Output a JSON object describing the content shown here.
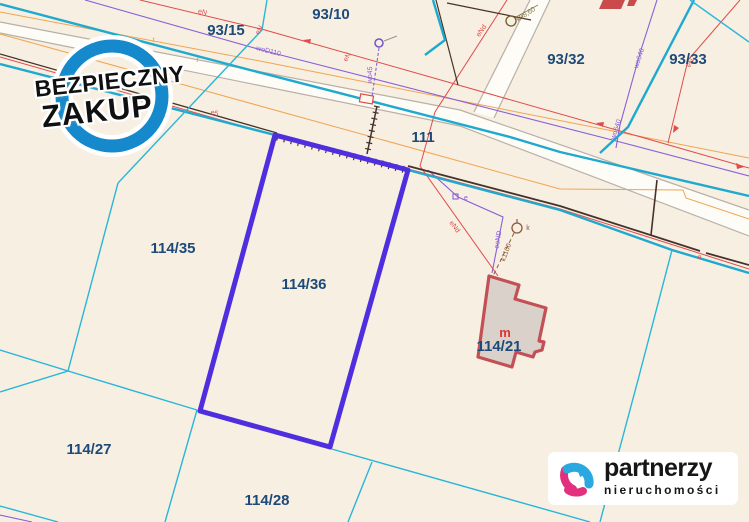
{
  "colors": {
    "background": "#f7efe2",
    "parcel_label": "#1d4a78",
    "boundary_cyan": "#21aed2",
    "highlight_purple": "#4f2ee0",
    "road_gray": "#b8b0a6",
    "utility_orange": "#e8973f",
    "utility_red": "#e14b4b",
    "utility_purple": "#8a5fd6",
    "fence_dark": "#46322a",
    "building_stroke": "#c25055",
    "building_fill": "#d9d1ca",
    "stamp_blue": "#1589cb",
    "logo_pink": "#e2307e",
    "logo_blue": "#2aa9e0"
  },
  "map": {
    "parcels": [
      {
        "label": "93/15"
      },
      {
        "label": "93/10"
      },
      {
        "label": "93/32"
      },
      {
        "label": "93/33"
      },
      {
        "label": "111"
      },
      {
        "label": "114/35"
      },
      {
        "label": "114/36"
      },
      {
        "label": "114/27"
      },
      {
        "label": "114/28"
      },
      {
        "label": "114/21"
      }
    ],
    "building_mark": "m",
    "utility_labels": [
      {
        "text": "eN"
      },
      {
        "text": "eN"
      },
      {
        "text": "eN"
      },
      {
        "text": "eN"
      },
      {
        "text": "eNd"
      },
      {
        "text": "eNd"
      },
      {
        "text": "e5"
      },
      {
        "text": "woD110"
      },
      {
        "text": "wo640"
      },
      {
        "text": "wo640"
      },
      {
        "text": "wo45"
      },
      {
        "text": "eoND"
      },
      {
        "text": "k1100"
      },
      {
        "text": "k"
      },
      {
        "text": "k98,60"
      },
      {
        "text": "t"
      },
      {
        "text": "t"
      },
      {
        "text": "e"
      },
      {
        "text": "e"
      }
    ]
  },
  "stamp": {
    "line1": "BEZPIECZNY",
    "line2": "ZAKUP"
  },
  "logo": {
    "brand": "partnerzy",
    "subtitle": "nieruchomości"
  }
}
